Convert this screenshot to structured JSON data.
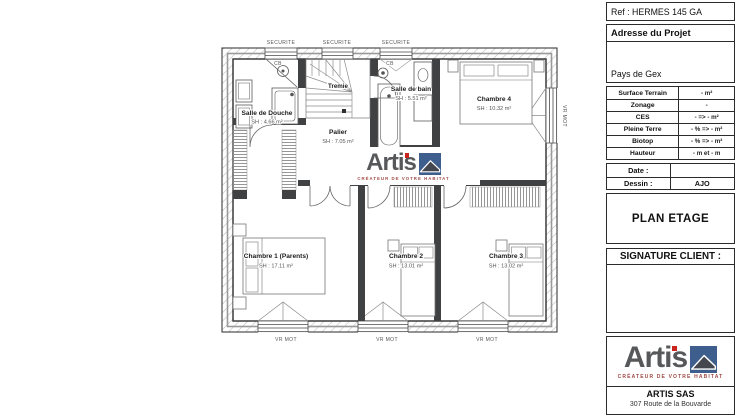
{
  "colors": {
    "accent_blue": "#3e5e8e",
    "logo_gray": "#57585a",
    "logo_red": "#c9251d",
    "wall_dark": "#3f4143"
  },
  "plan": {
    "securite_labels": [
      "SECURITE",
      "SECURITE",
      "SECURITE"
    ],
    "cb_labels": [
      "CB",
      "CB"
    ],
    "tremie_label": "Tremie",
    "vr_mot_labels": [
      "VR MOT",
      "VR MOT",
      "VR MOT",
      "VR MOT"
    ],
    "rooms": {
      "salle_de_douche": {
        "name": "Salle de Douche",
        "area": "SH : 4.66 m²"
      },
      "salle_de_bain": {
        "name": "Salle de bain",
        "area": "SH : 5.51 m²"
      },
      "chambre4": {
        "name": "Chambre 4",
        "area": "SH : 10.32 m²"
      },
      "palier": {
        "name": "Palier",
        "area": "SH : 7.05 m²"
      },
      "chambre1": {
        "name": "Chambre 1 (Parents)",
        "area": "SH : 17.11 m²"
      },
      "chambre2": {
        "name": "Chambre 2",
        "area": "SH : 13.01 m²"
      },
      "chambre3": {
        "name": "Chambre 3",
        "area": "SH : 13.02 m²"
      }
    },
    "watermark": {
      "brand": "Artis",
      "tagline": "CRÉATEUR DE VOTRE HABITAT"
    }
  },
  "panel": {
    "ref": "Ref : HERMES 145 GA",
    "address": {
      "title": "Adresse du Projet",
      "value": "Pays de Gex"
    },
    "specs": {
      "rows": [
        {
          "label": "Surface Terrain",
          "value": "- m²"
        },
        {
          "label": "Zonage",
          "value": "-"
        },
        {
          "label": "CES",
          "value": "- => - m²"
        },
        {
          "label": "Pleine Terre",
          "value": "- % => - m²"
        },
        {
          "label": "Biotop",
          "value": "- % => - m²"
        },
        {
          "label": "Hauteur",
          "value": "- m et - m"
        }
      ]
    },
    "meta": {
      "date_label": "Date :",
      "date_value": "",
      "dessin_label": "Dessin :",
      "dessin_value": "AJO"
    },
    "drawing_title": "PLAN ETAGE",
    "signature_title": "SIGNATURE CLIENT :",
    "logo": {
      "brand": "Artis",
      "tagline": "CRÉATEUR DE VOTRE HABITAT",
      "company": "ARTIS SAS",
      "address": "307 Route de la Bouvarde"
    }
  }
}
